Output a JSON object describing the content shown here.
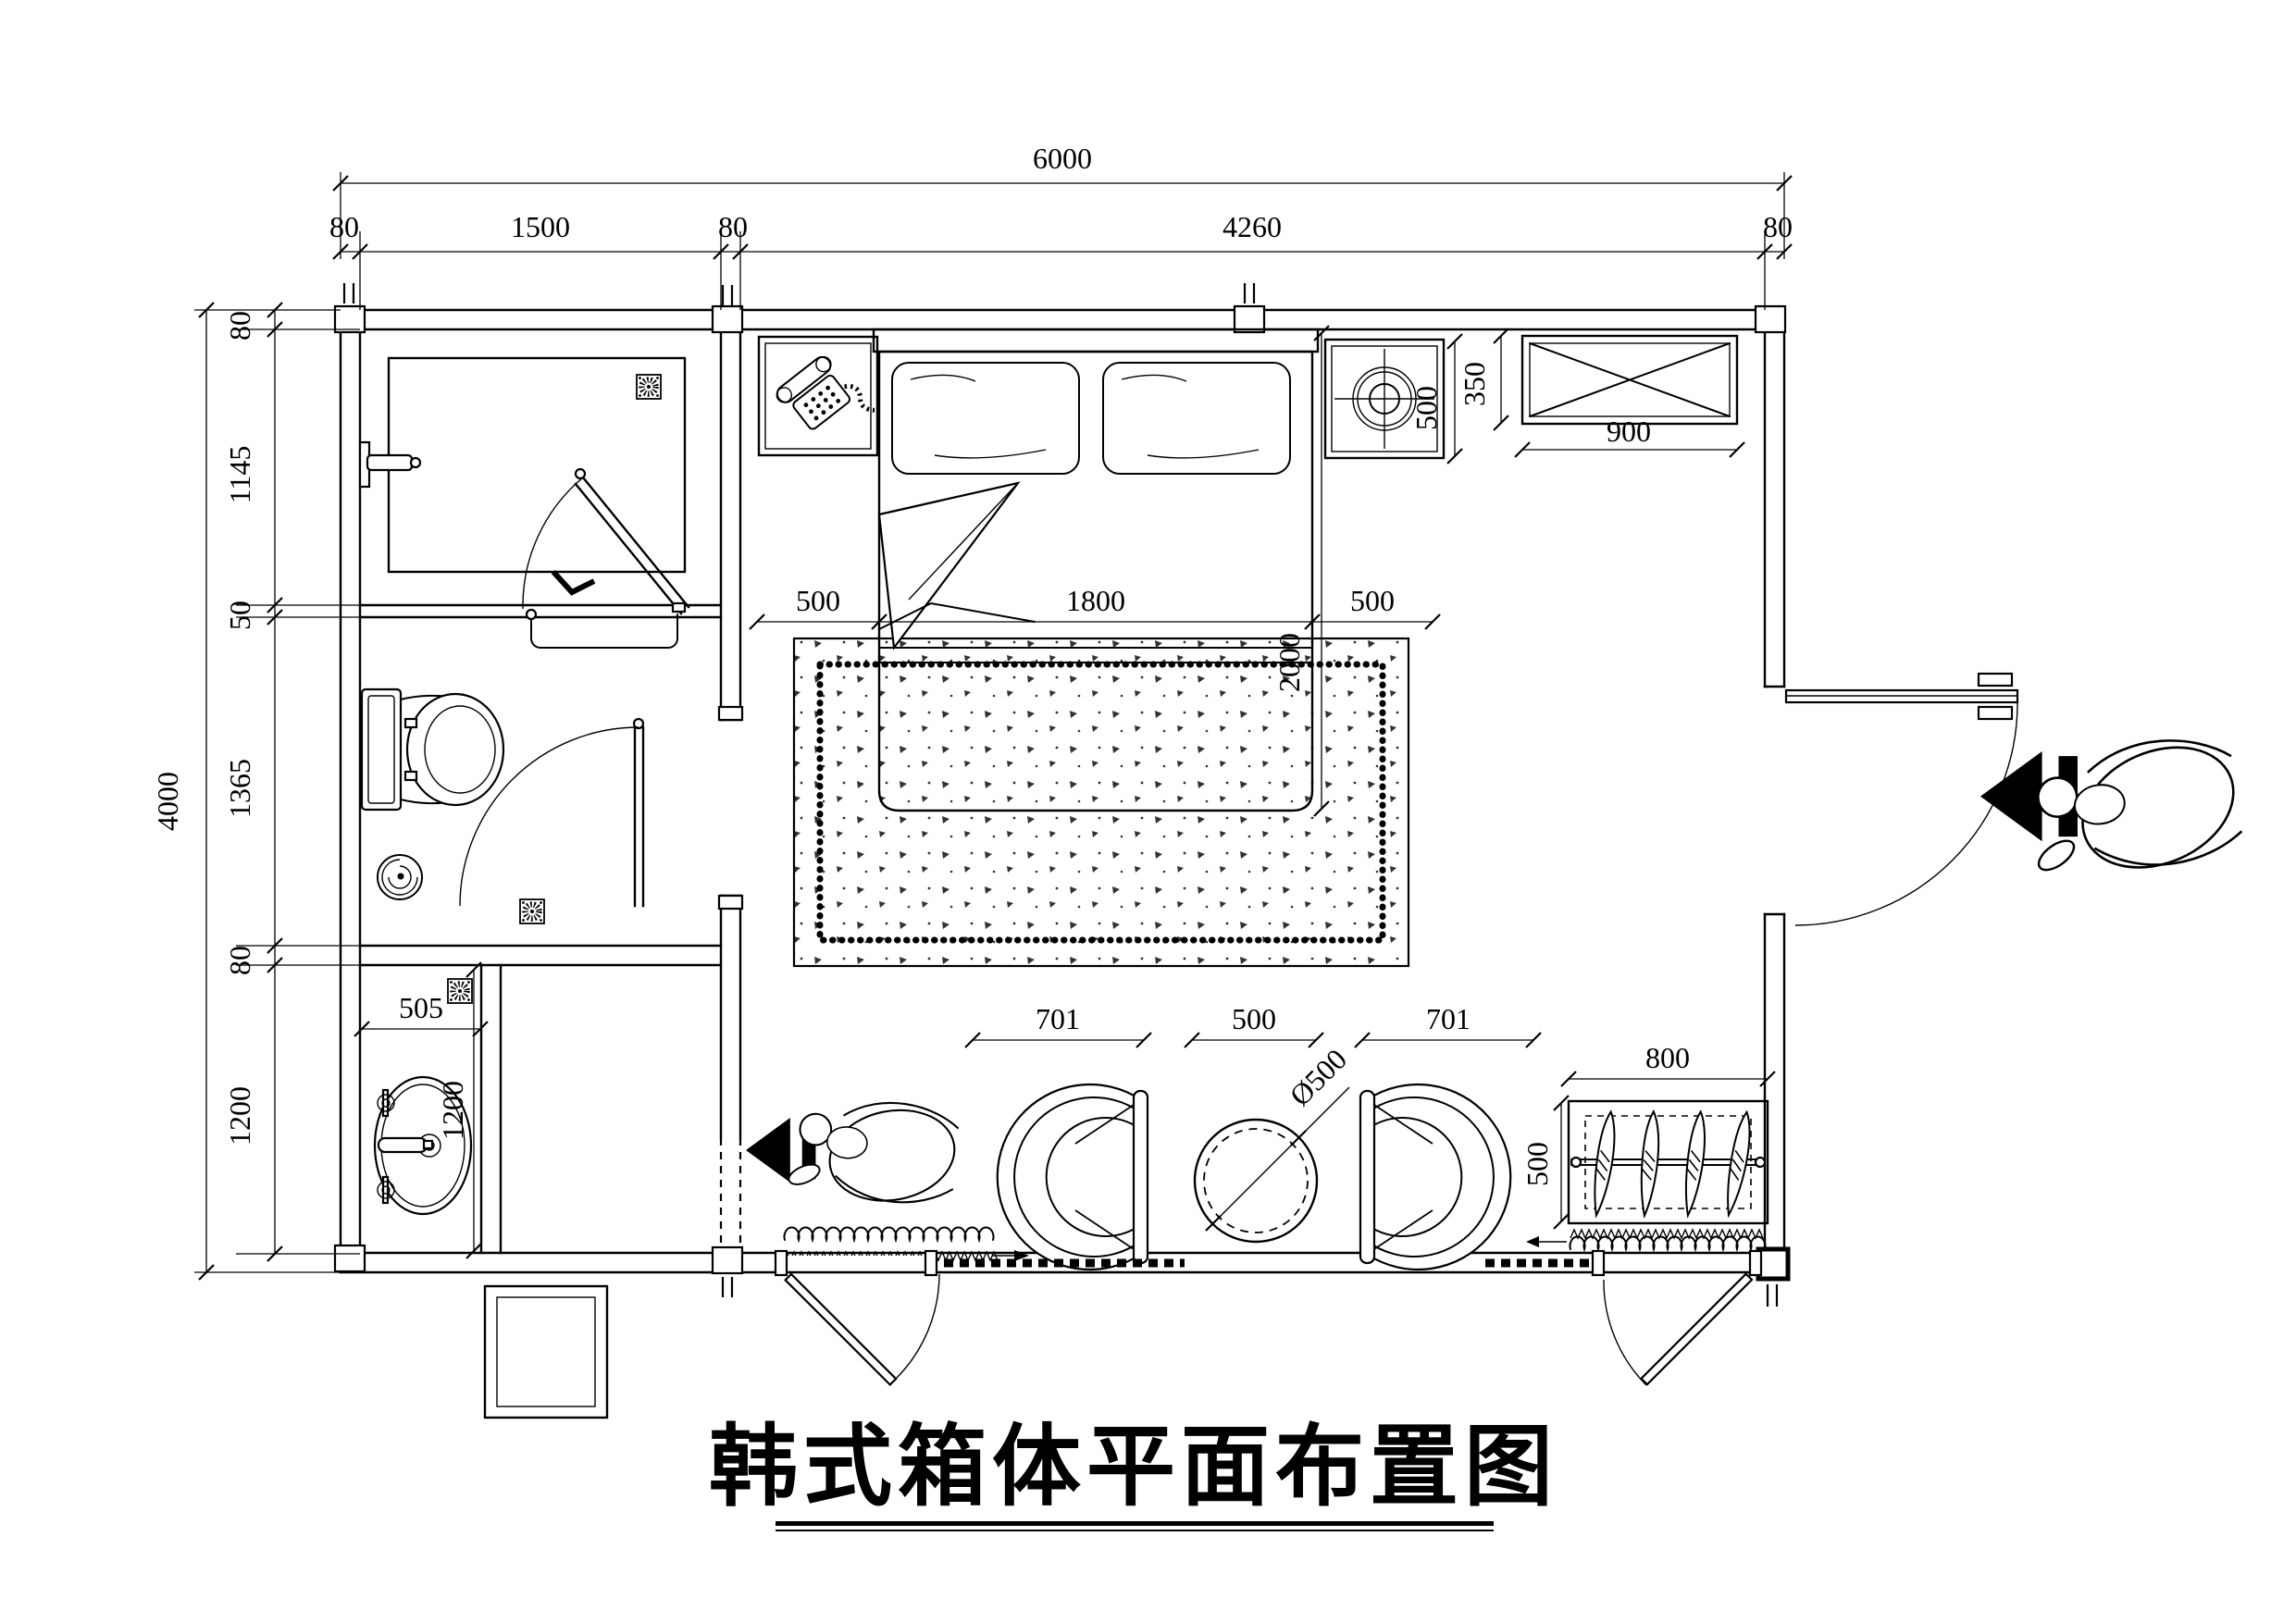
{
  "title": "韩式箱体平面布置图",
  "dims": {
    "overall_width": "6000",
    "top_segments": [
      "80",
      "1500",
      "80",
      "4260",
      "80"
    ],
    "overall_height": "4000",
    "left_segments": [
      "80",
      "1145",
      "50",
      "1365",
      "80",
      "1200"
    ],
    "bed_offset_left": "500",
    "bed_width": "1800",
    "bed_offset_right": "500",
    "bed_length": "2000",
    "stool_size": "500",
    "ac_depth": "350",
    "ac_width": "900",
    "sink_width": "505",
    "sink_depth": "1200",
    "chair_left": "701",
    "table_gap": "500",
    "chair_right": "701",
    "table_diameter": "Ø500",
    "wardrobe_width": "800",
    "wardrobe_depth": "500"
  }
}
